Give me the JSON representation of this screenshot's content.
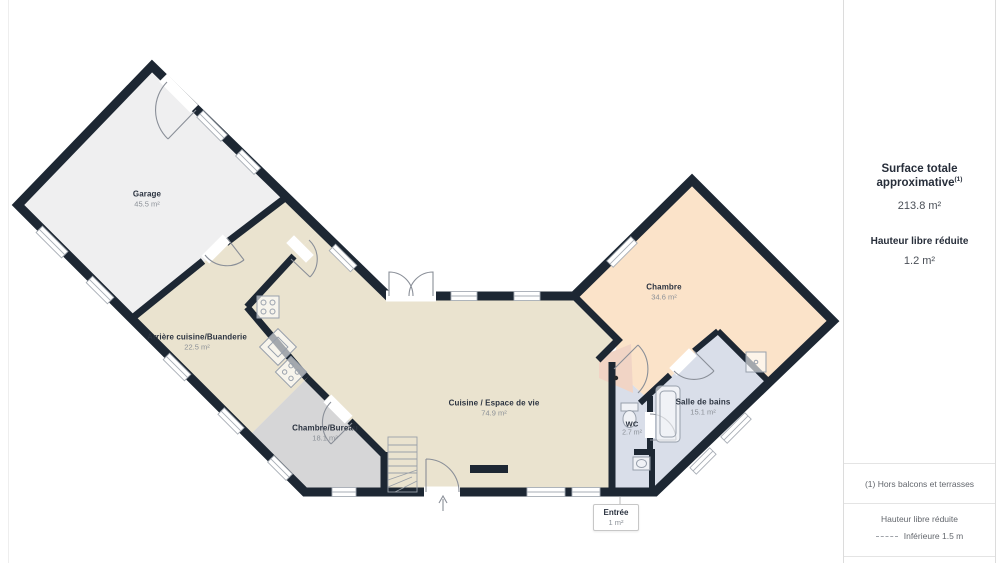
{
  "sidebar": {
    "title": "Surface totale approximative",
    "title_sup": "(1)",
    "total_area": "213.8 m²",
    "reduced_label": "Hauteur libre réduite",
    "reduced_value": "1.2 m²",
    "notes": {
      "note1": "(1) Hors balcons et terrasses",
      "legend_title": "Hauteur libre réduite",
      "legend_value": "Inférieure 1.5 m"
    }
  },
  "rooms": {
    "garage": {
      "name": "Garage",
      "area": "45.5 m²"
    },
    "arriere": {
      "name": "Arrière cuisine/Buanderie",
      "area": "22.5 m²"
    },
    "bureau": {
      "name": "Chambre/Bureau",
      "area": "18.1 m²"
    },
    "cuisine": {
      "name": "Cuisine / Espace de vie",
      "area": "74.9 m²"
    },
    "chambre": {
      "name": "Chambre",
      "area": "34.6 m²"
    },
    "sdb": {
      "name": "Salle de bains",
      "area": "15.1 m²"
    },
    "wc": {
      "name": "WC",
      "area": "2.7 m²"
    },
    "entree": {
      "name": "Entrée",
      "area": "1 m²"
    }
  },
  "colors": {
    "wall": "#1d2733",
    "beige": "#eae3cf",
    "gray": "#d6d6d7",
    "peach": "#fbe3c9",
    "blue": "#d9dee9",
    "garage_floor": "#efeff0",
    "entree_floor": "#f1d4c5"
  }
}
